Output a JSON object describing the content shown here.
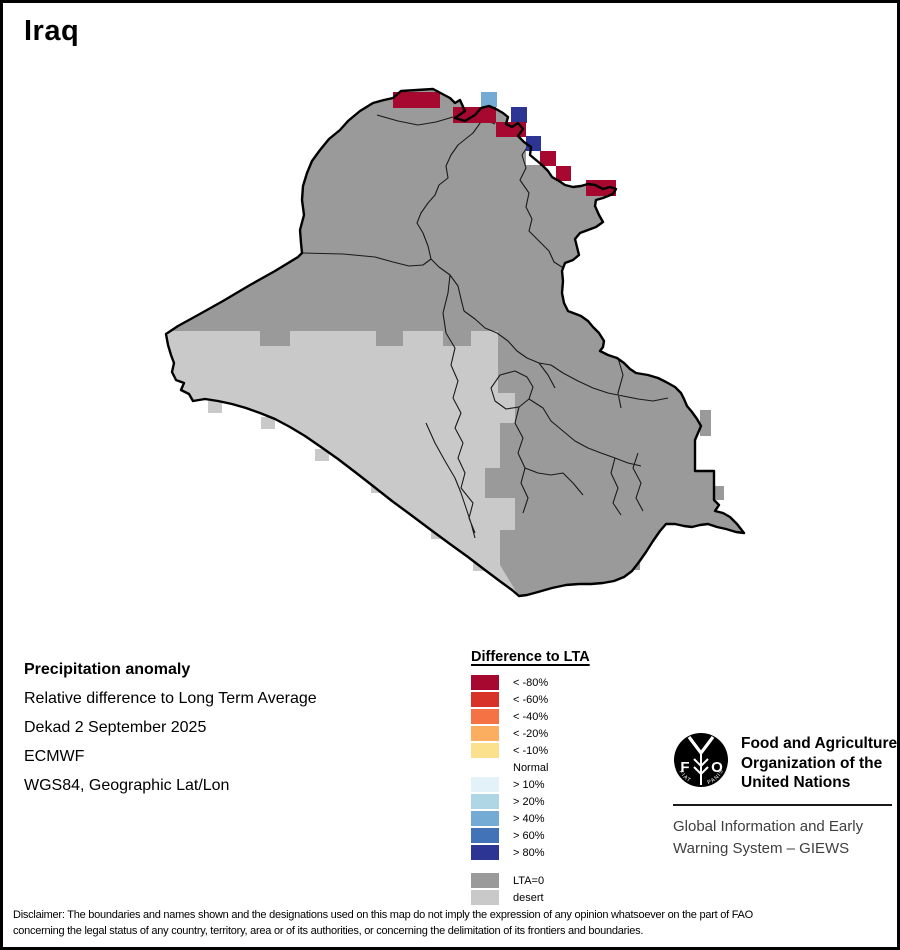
{
  "window": {
    "title": "Iraq"
  },
  "info": {
    "title": "Precipitation anomaly",
    "subtitle": "Relative difference to Long Term Average",
    "dekad": "Dekad 2 September 2025",
    "source": "ECMWF",
    "projection": "WGS84, Geographic Lat/Lon"
  },
  "legend": {
    "title": "Difference to LTA",
    "items": [
      {
        "label": "< -80%",
        "color": "#A7082F"
      },
      {
        "label": "< -60%",
        "color": "#D73329"
      },
      {
        "label": "< -40%",
        "color": "#F57245"
      },
      {
        "label": "< -20%",
        "color": "#FBAD60"
      },
      {
        "label": "< -10%",
        "color": "#FBE08D"
      },
      {
        "label": "Normal",
        "color": "#FFFFFF"
      },
      {
        "label": "> 10%",
        "color": "#E3F1F8"
      },
      {
        "label": "> 20%",
        "color": "#AFD6E4"
      },
      {
        "label": "> 40%",
        "color": "#74ABD4"
      },
      {
        "label": "> 60%",
        "color": "#4273B8"
      },
      {
        "label": "> 80%",
        "color": "#2D3594"
      }
    ],
    "base_items": [
      {
        "label": "LTA=0",
        "color": "#9A9A9A"
      },
      {
        "label": "desert",
        "color": "#C9C9C9"
      }
    ]
  },
  "map": {
    "country": "Iraq",
    "cells": [
      {
        "x": 390,
        "y": 89,
        "w": 47,
        "h": 16,
        "class": "< -80%"
      },
      {
        "x": 450,
        "y": 104,
        "w": 43,
        "h": 16,
        "class": "< -80%"
      },
      {
        "x": 478,
        "y": 89,
        "w": 16,
        "h": 15,
        "class": "> 40%"
      },
      {
        "x": 508,
        "y": 104,
        "w": 16,
        "h": 16,
        "class": "> 80%"
      },
      {
        "x": 493,
        "y": 119,
        "w": 30,
        "h": 15,
        "class": "< -80%"
      },
      {
        "x": 523,
        "y": 133,
        "w": 15,
        "h": 15,
        "class": "> 80%"
      },
      {
        "x": 523,
        "y": 148,
        "w": 14,
        "h": 14,
        "class": "Normal"
      },
      {
        "x": 537,
        "y": 148,
        "w": 16,
        "h": 15,
        "class": "< -80%"
      },
      {
        "x": 553,
        "y": 163,
        "w": 15,
        "h": 15,
        "class": "< -80%"
      },
      {
        "x": 583,
        "y": 177,
        "w": 30,
        "h": 16,
        "class": "< -80%"
      }
    ]
  },
  "branding": {
    "org_lines": [
      "Food and Agriculture",
      "Organization of the",
      "United Nations"
    ],
    "giews_lines": [
      "Global Information and Early",
      "Warning System – GIEWS"
    ],
    "logo_letters": {
      "f": "F",
      "o": "O",
      "fiat": "FIAT",
      "panis": "PANIS"
    }
  },
  "disclaimer": {
    "line1": "Disclaimer: The boundaries and names shown and the designations used on this map do not imply the expression of any opinion whatsoever on the part of FAO",
    "line2": "concerning the legal status of any country, territory, area or of its authorities, or concerning the delimitation of its frontiers and boundaries."
  },
  "colors": {
    "lta0": "#9A9A9A",
    "desert": "#C9C9C9",
    "outline": "#000000",
    "admin_line": "#1a1a1a"
  }
}
